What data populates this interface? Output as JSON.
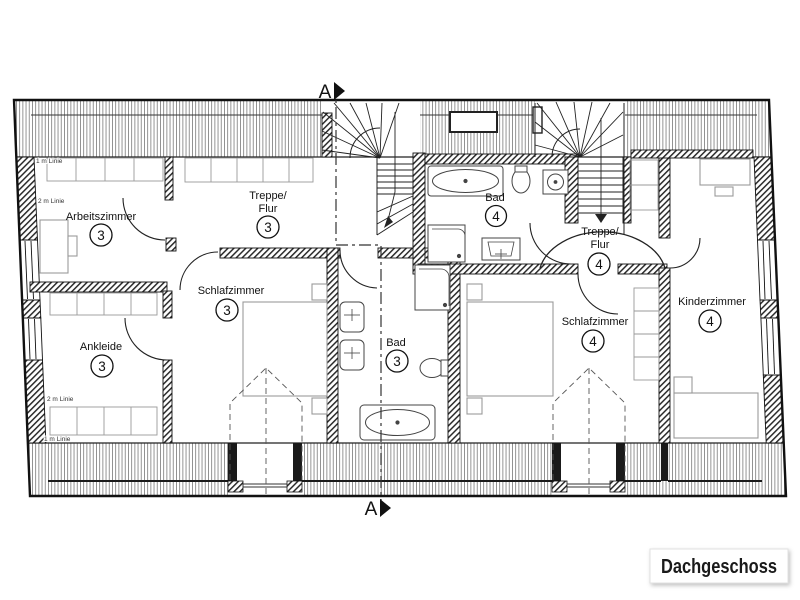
{
  "plan": {
    "floor_label": "Dachgeschoss",
    "section_markers": {
      "top": "A",
      "bottom": "A"
    },
    "height_lines": {
      "one_meter": "1 m Linie",
      "two_meter": "2 m Linie"
    },
    "rooms": [
      {
        "id": "arbeitszimmer",
        "label": "Arbeitszimmer",
        "apartment": "3"
      },
      {
        "id": "treppe-flur-3",
        "label_line1": "Treppe/",
        "label_line2": "Flur",
        "apartment": "3"
      },
      {
        "id": "schlafzimmer-3",
        "label": "Schlafzimmer",
        "apartment": "3"
      },
      {
        "id": "ankleide",
        "label": "Ankleide",
        "apartment": "3"
      },
      {
        "id": "bad-3",
        "label": "Bad",
        "apartment": "3"
      },
      {
        "id": "bad-4",
        "label": "Bad",
        "apartment": "4"
      },
      {
        "id": "treppe-flur-4",
        "label_line1": "Treppe/",
        "label_line2": "Flur",
        "apartment": "4"
      },
      {
        "id": "schlafzimmer-4",
        "label": "Schlafzimmer",
        "apartment": "4"
      },
      {
        "id": "kinderzimmer",
        "label": "Kinderzimmer",
        "apartment": "4"
      }
    ],
    "colors": {
      "wall": "#1a1a1a",
      "line": "#333333",
      "furniture": "#9a9a9a",
      "background": "#ffffff"
    }
  }
}
